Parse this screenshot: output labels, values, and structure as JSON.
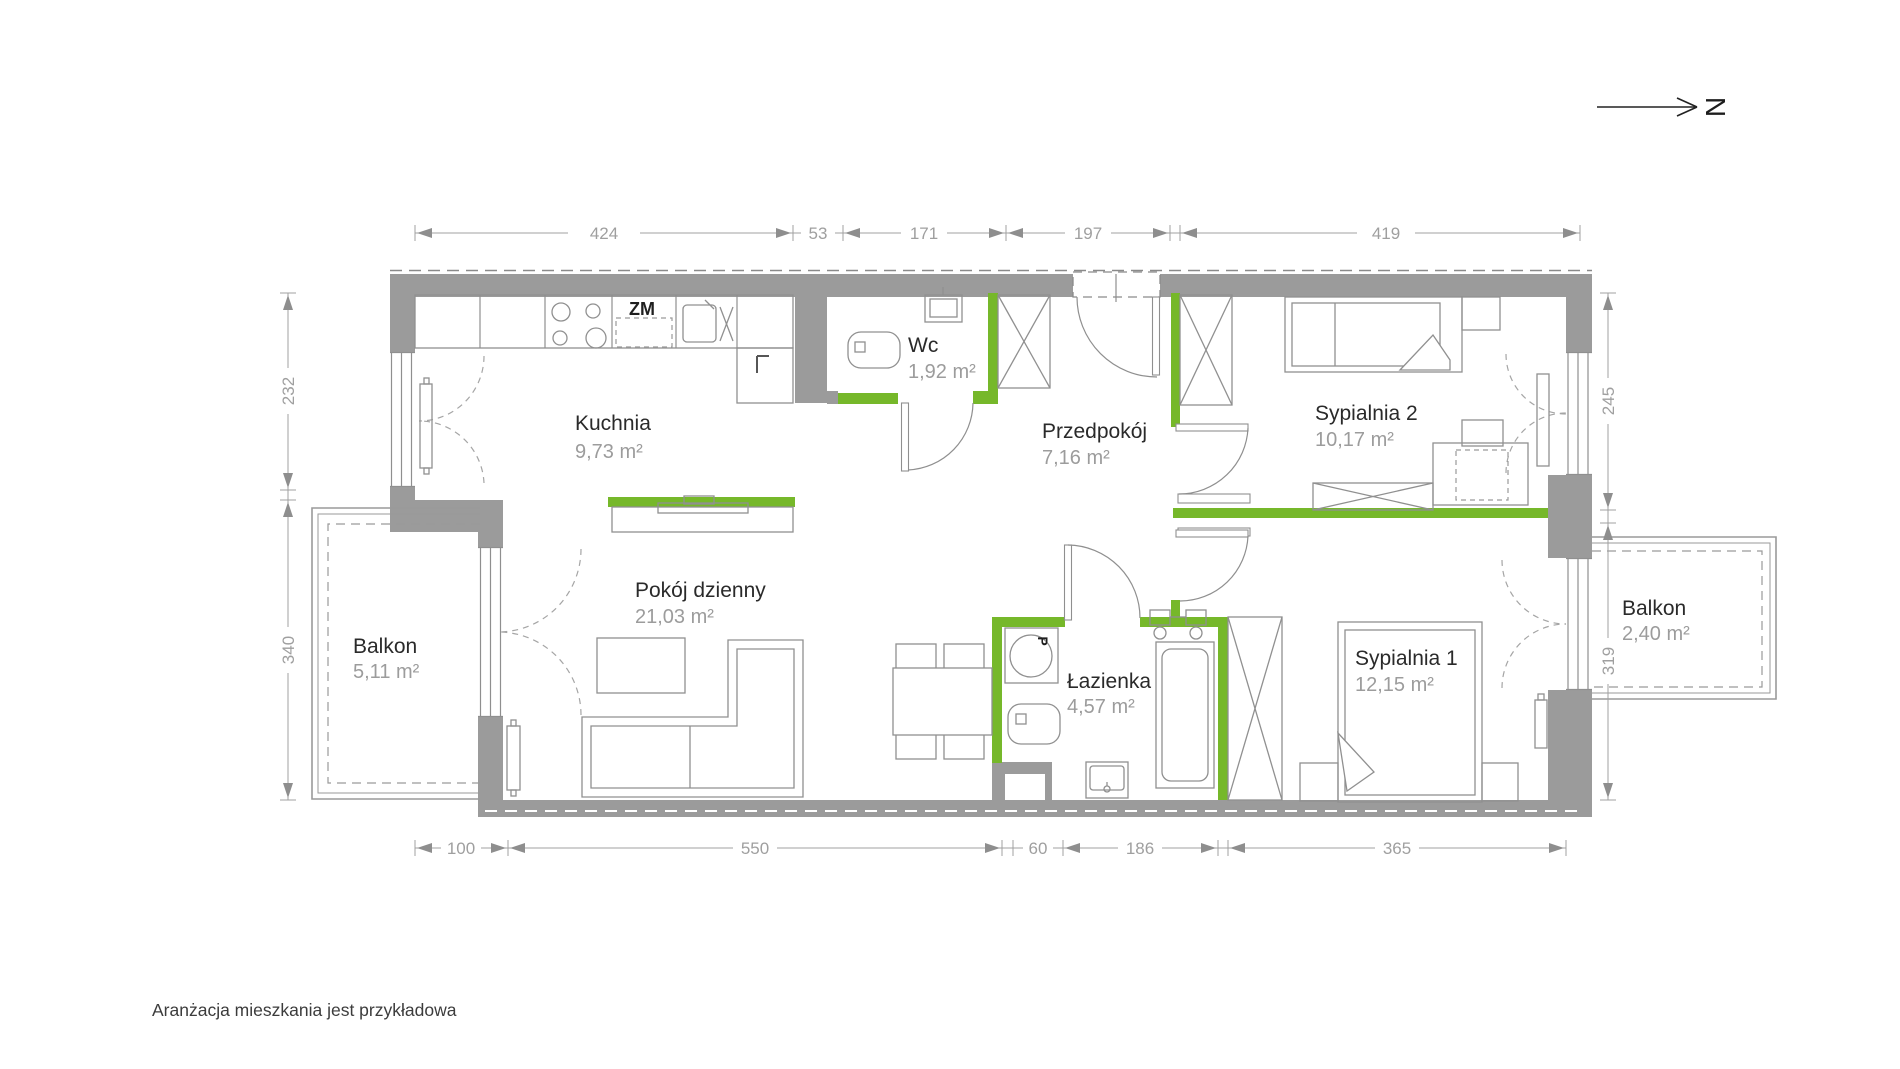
{
  "meta": {
    "footer_note": "Aranżacja mieszkania jest przykładowa",
    "north_label": "N"
  },
  "appliance_labels": {
    "dishwasher": "ZM",
    "washing_machine": "P"
  },
  "rooms": {
    "kuchnia": {
      "name": "Kuchnia",
      "area": "9,73 m²"
    },
    "wc": {
      "name": "Wc",
      "area": "1,92 m²"
    },
    "przedpokoj": {
      "name": "Przedpokój",
      "area": "7,16 m²"
    },
    "sypialnia2": {
      "name": "Sypialnia 2",
      "area": "10,17 m²"
    },
    "pokoj_dzienny": {
      "name": "Pokój dzienny",
      "area": "21,03 m²"
    },
    "lazienka": {
      "name": "Łazienka",
      "area": "4,57 m²"
    },
    "sypialnia1": {
      "name": "Sypialnia 1",
      "area": "12,15 m²"
    },
    "balkon_lewy": {
      "name": "Balkon",
      "area": "5,11 m²"
    },
    "balkon_prawy": {
      "name": "Balkon",
      "area": "2,40 m²"
    }
  },
  "dimensions": {
    "top": [
      "424",
      "53",
      "171",
      "197",
      "419"
    ],
    "bottom": [
      "100",
      "550",
      "60",
      "186",
      "365"
    ],
    "left": [
      "232",
      "340"
    ],
    "right": [
      "245",
      "319"
    ]
  },
  "colors": {
    "accent_green": "#76B82A",
    "wall_gray": "#9B9B9B",
    "dim_gray": "#9F9F9F"
  }
}
